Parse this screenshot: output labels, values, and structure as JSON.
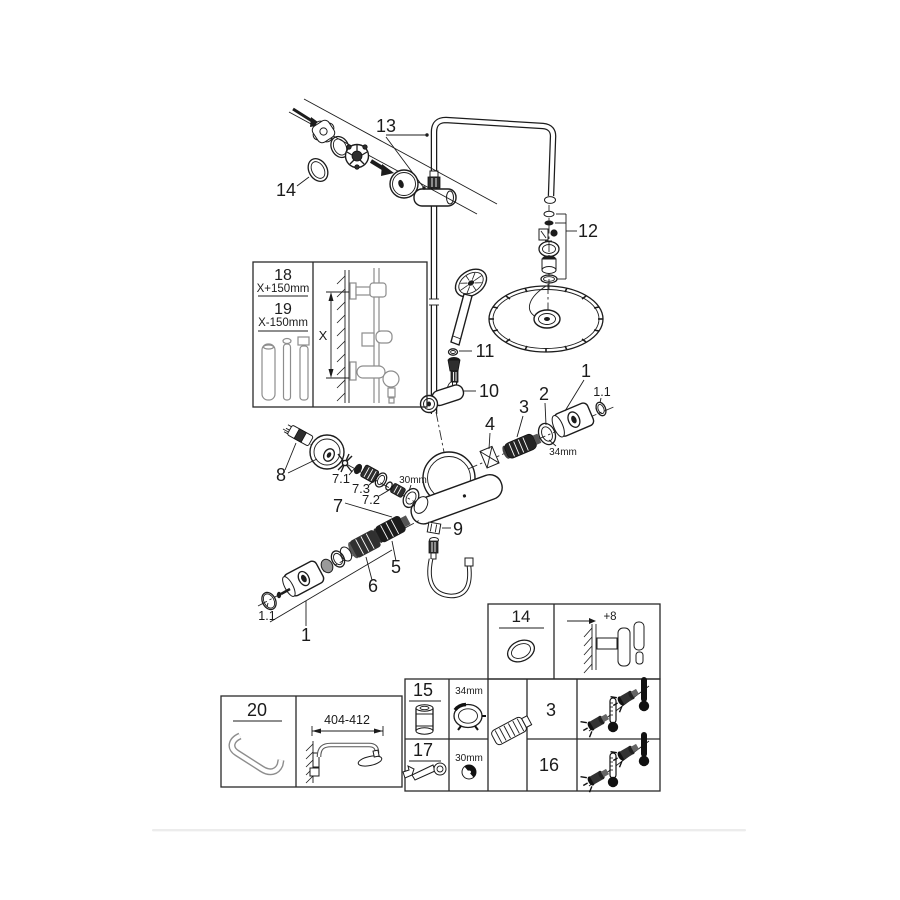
{
  "callouts": {
    "c13": "13",
    "c14": "14",
    "c12": "12",
    "c11": "11",
    "c10": "10",
    "c9": "9",
    "c8": "8",
    "c7": "7",
    "c7_1": "7.1",
    "c7_2": "7.2",
    "c7_3": "7.3",
    "c6": "6",
    "c5": "5",
    "c4": "4",
    "c3": "3",
    "c2": "2",
    "c1_right": "1",
    "c1_1_right": "1.1",
    "c1_bottom": "1",
    "c1_1_bottom": "1.1",
    "size_34mm": "34mm",
    "size_30mm": "30mm"
  },
  "length_inset": {
    "part_upper": "18",
    "dim_upper": "X+150mm",
    "part_lower": "19",
    "dim_lower": "X-150mm",
    "axis": "X"
  },
  "seal_table": {
    "part": "14",
    "wall_offset": "+8"
  },
  "service_table": {
    "rows": [
      {
        "part": "15",
        "size": "34mm"
      },
      {
        "part": "17",
        "size": "30mm"
      }
    ],
    "applies_to": [
      {
        "part": "3"
      },
      {
        "part": "16"
      }
    ]
  },
  "arm_table": {
    "part": "20",
    "dim": "404-412"
  }
}
